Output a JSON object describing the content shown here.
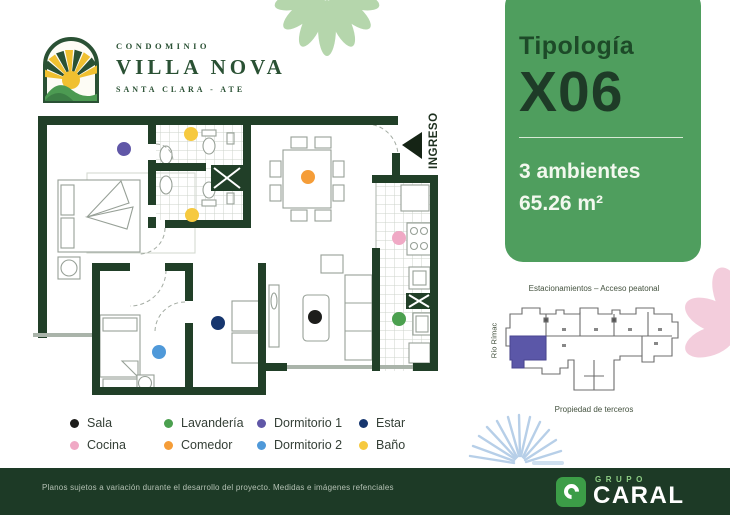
{
  "brand": {
    "condominio_label": "CONDOMINIO",
    "name": "VILLA NOVA",
    "location": "SANTA CLARA - ATE",
    "logo_green": "#2a5134",
    "logo_yellow": "#f0c030",
    "logo_hill_green": "#4c9a52"
  },
  "typology_panel": {
    "label": "Tipología",
    "code": "X06",
    "ambientes": "3 ambientes",
    "area": "65.26 m²",
    "bg_color": "#4f9e5e",
    "label_color": "#1d4a28",
    "code_color": "#1e3b27"
  },
  "floor_plan": {
    "ingreso_label": "INGRESO",
    "wall_color": "#213f28"
  },
  "site_plan": {
    "top_label": "Estacionamientos – Acceso peatonal",
    "left_label": "Río Rímac",
    "bottom_label": "Propiedad de terceros",
    "highlight_color": "#5b57a8"
  },
  "legend": {
    "items": [
      {
        "label": "Sala",
        "color": "#1d1d1b"
      },
      {
        "label": "Lavandería",
        "color": "#4ba04f"
      },
      {
        "label": "Dormitorio 1",
        "color": "#6057a7"
      },
      {
        "label": "Estar",
        "color": "#16366e"
      },
      {
        "label": "Cocina",
        "color": "#f0a9c5"
      },
      {
        "label": "Comedor",
        "color": "#f59d38"
      },
      {
        "label": "Dormitorio 2",
        "color": "#4f99d9"
      },
      {
        "label": "Baño",
        "color": "#f6c93f"
      }
    ]
  },
  "footer": {
    "disclaimer": "Planos sujetos a variación durante el desarrollo del proyecto. Medidas e imágenes refenciales",
    "group_label": "GRUPO",
    "company": "CARAL",
    "bar_color": "#1d3a26",
    "accent_color": "#3c9d47"
  }
}
